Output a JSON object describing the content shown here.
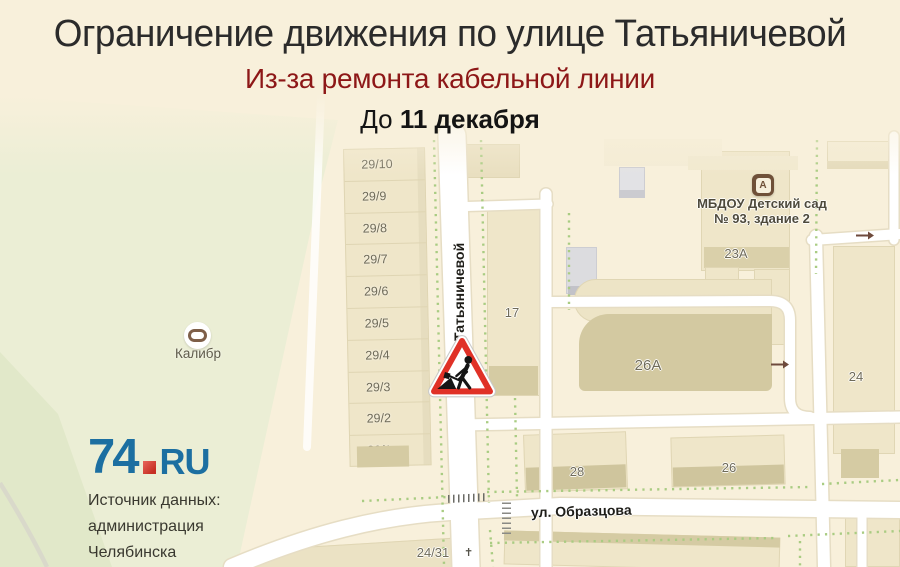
{
  "header": {
    "title": "Ограничение движения по улице Татьяничевой",
    "subtitle": "Из-за ремонта кабельной линии",
    "date_prefix": "До ",
    "date_bold": "11 декабря"
  },
  "map": {
    "street_vertical": "ул. Татьяничевой",
    "street_horizontal": "ул. Образцова",
    "buildings_29": [
      "29/10",
      "29/9",
      "29/8",
      "29/7",
      "29/6",
      "29/5",
      "29/4",
      "29/3",
      "29/2",
      "29/1"
    ],
    "labels": [
      {
        "text": "17",
        "x": 512,
        "y": 305
      },
      {
        "text": "23А",
        "x": 736,
        "y": 246
      },
      {
        "text": "26А",
        "x": 648,
        "y": 357,
        "size": 15
      },
      {
        "text": "24",
        "x": 856,
        "y": 369
      },
      {
        "text": "28",
        "x": 577,
        "y": 464
      },
      {
        "text": "26",
        "x": 729,
        "y": 460
      },
      {
        "text": "24/31",
        "x": 433,
        "y": 545
      }
    ],
    "poi_kalibr_label": "Калибр",
    "kindergarten": {
      "icon_letter": "А",
      "line1": "МБДОУ Детский сад",
      "line2": "№ 93, здание 2"
    },
    "roadwork_sign": "roadworks-sign"
  },
  "footer": {
    "logo_part1": "74",
    "logo_part2": "RU",
    "source_lines": [
      "Источник данных:",
      "администрация",
      "Челябинска"
    ]
  },
  "colors": {
    "background": "#F8F0DB",
    "subtitle_red": "#8D1717",
    "sign_red": "#E03127",
    "logo_blue": "#1C6FA1",
    "logo_red": "#D93A2B",
    "park_green": "#EBEED5",
    "building_tan": "#EFE6C9",
    "building_dark": "#D5CBA3",
    "road_white": "#FFFFFF",
    "path_dot_green": "#A9CC82"
  }
}
